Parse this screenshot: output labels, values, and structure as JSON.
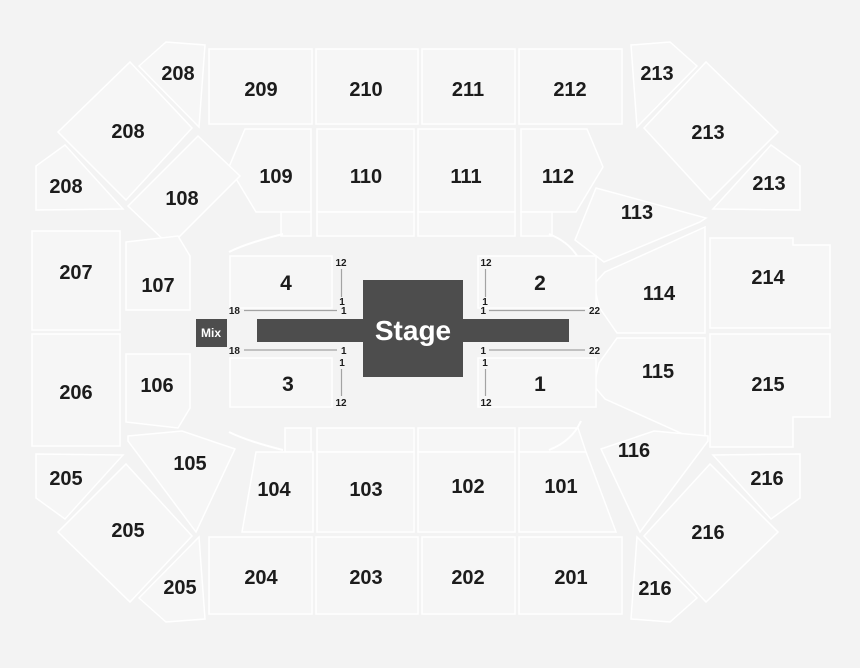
{
  "colors": {
    "background": "#f3f3f3",
    "section_fill": "#f6f6f6",
    "section_stroke": "#ffffff",
    "label_color": "#1c1c1c",
    "stage_fill": "#4d4d4d",
    "stage_text": "#ffffff",
    "marker_line": "#a3a3a3"
  },
  "stage": {
    "label": "Stage"
  },
  "mix": {
    "label": "Mix"
  },
  "floor": {
    "s1": "1",
    "s2": "2",
    "s3": "3",
    "s4": "4"
  },
  "inner": {
    "s101": "101",
    "s102": "102",
    "s103": "103",
    "s104": "104",
    "s105": "105",
    "s106": "106",
    "s107": "107",
    "s108": "108",
    "s109": "109",
    "s110": "110",
    "s111": "111",
    "s112": "112",
    "s113": "113",
    "s114": "114",
    "s115": "115",
    "s116": "116"
  },
  "outer": {
    "s201": "201",
    "s202": "202",
    "s203": "203",
    "s204": "204",
    "s205": "205",
    "s206": "206",
    "s207": "207",
    "s208": "208",
    "s209": "209",
    "s210": "210",
    "s211": "211",
    "s212": "212",
    "s213": "213",
    "s214": "214",
    "s215": "215",
    "s216": "216"
  },
  "markers": {
    "m1": "1",
    "m12": "12",
    "m18": "18",
    "m22": "22"
  }
}
